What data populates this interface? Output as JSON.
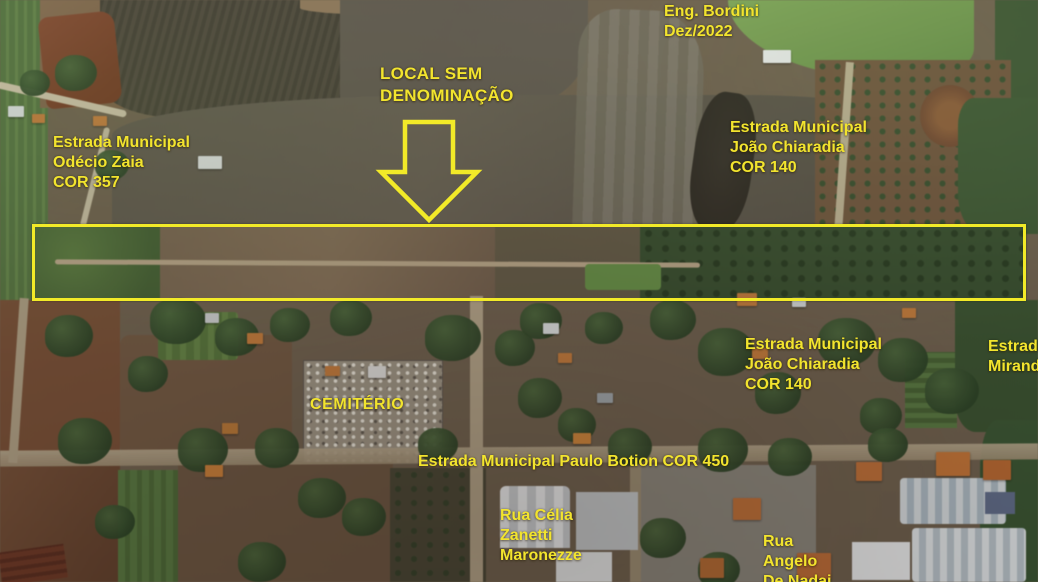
{
  "map": {
    "credit": {
      "line1": "Eng. Bordini",
      "line2": "Dez/2022"
    },
    "labels": {
      "local_sem_denominacao": {
        "line1": "LOCAL SEM",
        "line2": "DENOMINAÇÃO"
      },
      "estrada_odecio_zaia": {
        "line1": "Estrada Municipal",
        "line2": "Odécio Zaia",
        "line3": "COR 357"
      },
      "estrada_joao_chiaradia_norte": {
        "line1": "Estrada Municipal",
        "line2": "João Chiaradia",
        "line3": "COR 140"
      },
      "estrada_joao_chiaradia_sul": {
        "line1": "Estrada Municipal",
        "line2": "João Chiaradia",
        "line3": "COR 140"
      },
      "estrada_miranda_clipped": {
        "line1": "Estrada",
        "line2": "Mirand"
      },
      "cemiterio": {
        "line1": "CEMITÉRIO"
      },
      "estrada_paulo_botion": {
        "line1": "Estrada Municipal Paulo Botion COR 450"
      },
      "rua_celia_zanetti": {
        "line1": "Rua Célia",
        "line2": "Zanetti",
        "line3": "Maronezze"
      },
      "rua_angelo_de_nadai": {
        "line1": "Rua",
        "line2": "Angelo",
        "line3": "De Nadai"
      }
    },
    "colors": {
      "annotation_yellow": "#f2e42e",
      "highlight_rect_yellow": "#f2ea28"
    }
  }
}
